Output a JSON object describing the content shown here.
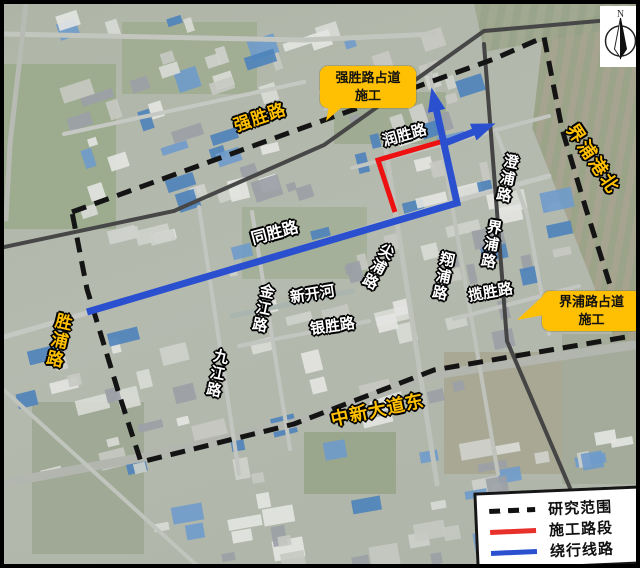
{
  "map_type": "satellite-annotation-map",
  "colors": {
    "accent_yellow": "#FFC003",
    "construction_red": "#EE1111",
    "detour_blue": "#2B50CF",
    "boundary_black": "#141414"
  },
  "callouts": {
    "qiangsheng": {
      "line1": "强胜路占道",
      "line2": "施工"
    },
    "jiepu": {
      "line1": "界浦路占道",
      "line2": "施工"
    }
  },
  "road_labels": {
    "qiangshenglu": "强胜路",
    "runshenglu": "润胜路",
    "jiepugangbei": "界浦港北",
    "chengpulu": "澄浦路",
    "jiepulu": "界浦路",
    "lanshenglu": "揽胜路",
    "tongshenglu": "同胜路",
    "jianpulu": "尖浦路",
    "xiangpulu": "翔浦路",
    "jinjianglu": "金江路",
    "xinkaihe": "新开河",
    "yinshenglu": "银胜路",
    "jiujianglu": "九江路",
    "shengpulu": "胜浦路",
    "zhongxindadaodong": "中新大道东"
  },
  "legend": {
    "items": [
      {
        "label": "研究范围",
        "style": "dashed-black"
      },
      {
        "label": "施工路段",
        "style": "solid-red"
      },
      {
        "label": "绕行线路",
        "style": "solid-blue"
      }
    ]
  },
  "compass": {
    "label": "N"
  }
}
